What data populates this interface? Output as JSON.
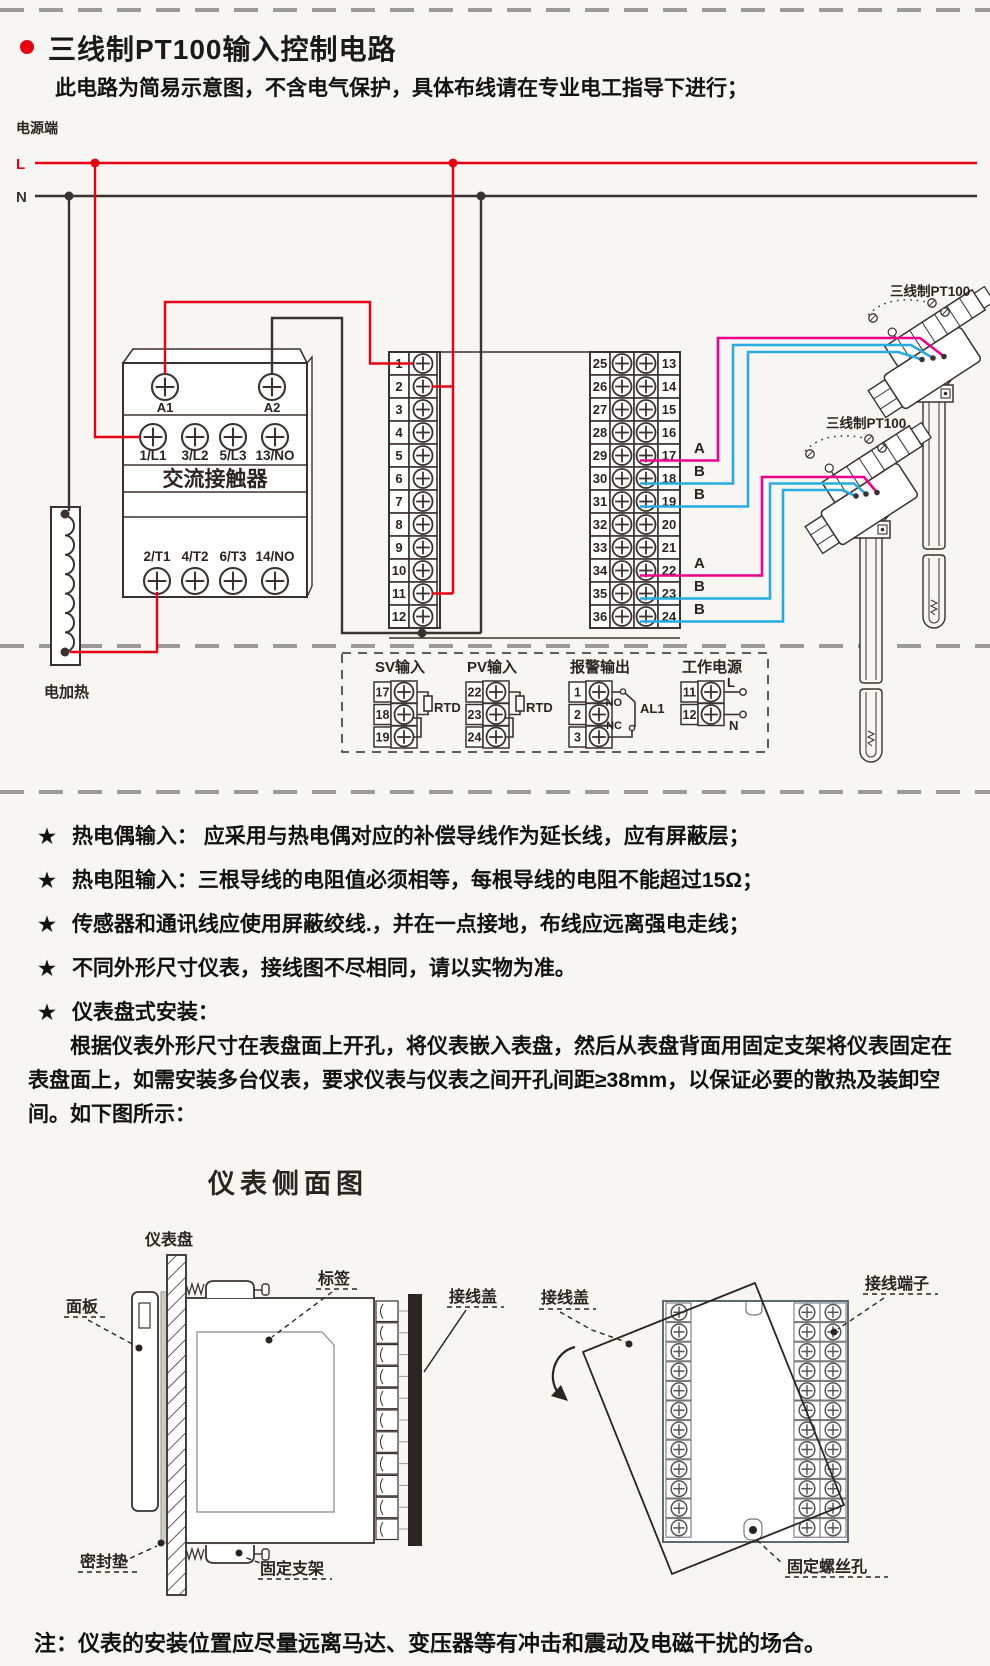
{
  "header": {
    "title": "三线制PT100输入控制电路",
    "subtitle": "此电路为简易示意图，不含电气保护，具体布线请在专业电工指导下进行；"
  },
  "circuit": {
    "power_label": "电源端",
    "line_l": "L",
    "line_n": "N",
    "contactor": {
      "title": "交流接触器",
      "coil": [
        "A1",
        "A2"
      ],
      "top_row": [
        "1/L1",
        "3/L2",
        "5/L3",
        "13/NO"
      ],
      "bottom_row": [
        "2/T1",
        "4/T2",
        "6/T3",
        "14/NO"
      ]
    },
    "heater_label": "电加热",
    "left_strip_numbers": [
      "1",
      "2",
      "3",
      "4",
      "5",
      "6",
      "7",
      "8",
      "9",
      "10",
      "11",
      "12"
    ],
    "right_strip_left_numbers": [
      "25",
      "26",
      "27",
      "28",
      "29",
      "30",
      "31",
      "32",
      "33",
      "34",
      "35",
      "36"
    ],
    "right_strip_right_numbers": [
      "13",
      "14",
      "15",
      "16",
      "17",
      "18",
      "19",
      "20",
      "21",
      "22",
      "23",
      "24"
    ],
    "upper_sensor": {
      "label": "三线制PT100",
      "wires": [
        "A",
        "B",
        "B"
      ]
    },
    "lower_sensor": {
      "label": "三线制PT100",
      "wires": [
        "A",
        "B",
        "B"
      ]
    },
    "io_groups": {
      "sv": {
        "title": "SV输入",
        "terminals": [
          "17",
          "18",
          "19"
        ],
        "component": "RTD"
      },
      "pv": {
        "title": "PV输入",
        "terminals": [
          "22",
          "23",
          "24"
        ],
        "component": "RTD"
      },
      "alarm": {
        "title": "报警输出",
        "terminals": [
          "1",
          "2",
          "3"
        ],
        "no_label": "NO",
        "nc_label": "NC",
        "relay_label": "AL1"
      },
      "supply": {
        "title": "工作电源",
        "terminals": [
          "11",
          "12"
        ],
        "l_label": "L",
        "n_label": "N"
      }
    }
  },
  "notes": {
    "bullet": "★",
    "items": [
      "热电偶输入： 应采用与热电偶对应的补偿导线作为延长线，应有屏蔽层；",
      "热电阻输入：三根导线的电阻值必须相等，每根导线的电阻不能超过15Ω；",
      "传感器和通讯线应使用屏蔽绞线.，并在一点接地，布线应远离强电走线；",
      "不同外形尺寸仪表，接线图不尽相同，请以实物为准。",
      "仪表盘式安装："
    ]
  },
  "install_paragraph": "根据仪表外形尺寸在表盘面上开孔，将仪表嵌入表盘，然后从表盘背面用固定支架将仪表固定在表盘面上，如需安装多台仪表，要求仪表与仪表之间开孔间距≥38mm，以保证必要的散热及装卸空间。如下图所示：",
  "side_view": {
    "title": "仪表侧面图",
    "labels": {
      "panel_board": "仪表盘",
      "front_panel": "面板",
      "sticker": "标签",
      "terminal_cover": "接线盖",
      "gasket": "密封垫",
      "bracket": "固定支架"
    }
  },
  "rear_view": {
    "labels": {
      "terminal_cover": "接线盖",
      "terminals": "接线端子",
      "screw_hole": "固定螺丝孔"
    }
  },
  "footer_note": "注：仪表的安装位置应尽量远离马达、变压器等有冲击和震动及电磁干扰的场合。",
  "colors": {
    "live": "#e60012",
    "wire_a": "#ec008c",
    "wire_b": "#29abe2",
    "line": "#3a3230",
    "dash": "#9a9a9a"
  }
}
